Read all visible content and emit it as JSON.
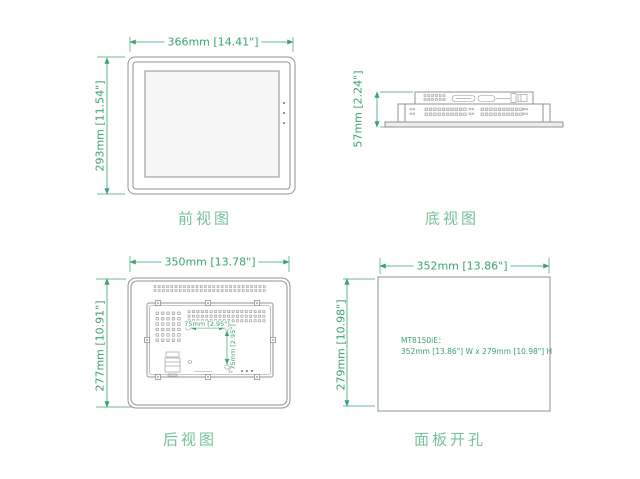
{
  "colors": {
    "dimension_green": "#3aa36f",
    "caption_green": "#74c299",
    "line_gray": "#8f9296",
    "background": "#ffffff"
  },
  "views": {
    "front": {
      "caption": "前视图",
      "width_dim": "366mm [14.41\"]",
      "height_dim": "293mm [11.54\"]"
    },
    "bottom": {
      "caption": "底视图",
      "depth_dim": "57mm [2.24\"]"
    },
    "rear": {
      "caption": "后视图",
      "width_dim": "350mm [13.78\"]",
      "height_dim": "277mm [10.91\"]",
      "vesa_width_dim": "75mm [2.95\"]",
      "vesa_height_dim": "75mm [2.95\"]"
    },
    "cutout": {
      "caption": "面板开孔",
      "width_dim": "352mm [13.86\"]",
      "height_dim": "279mm [10.98\"]",
      "model_label": "MT8150iE：",
      "size_note": "352mm [13.86\"] W x 279mm [10.98\"] H"
    }
  }
}
